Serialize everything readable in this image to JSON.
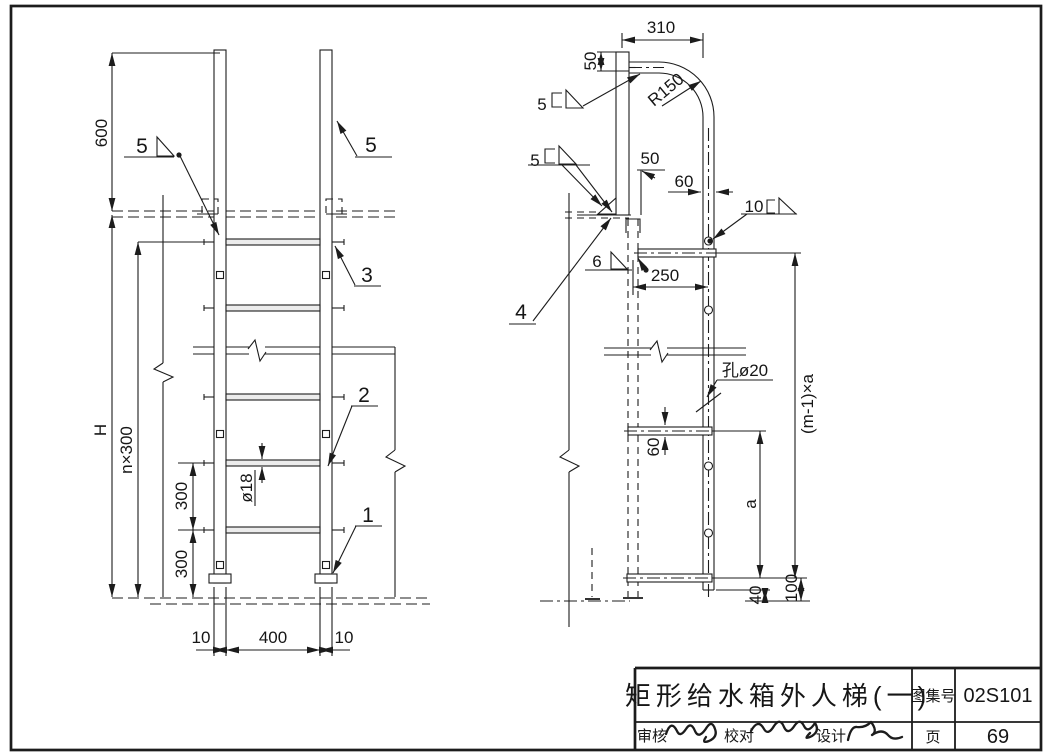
{
  "front_view": {
    "dims": {
      "height_600": "600",
      "tank_h": "H",
      "pitch_total": "n×300",
      "pitch_300a": "300",
      "pitch_300b": "300",
      "rung_dia": "ø18",
      "thk_left": "10",
      "width_400": "400",
      "thk_right": "10"
    },
    "parts": {
      "p1": "1",
      "p2": "2",
      "p3": "3",
      "p5_left": "5",
      "p5_right": "5"
    }
  },
  "side_view": {
    "dims": {
      "run_310": "310",
      "drop_50": "50",
      "radius": "R150",
      "offset_50": "50",
      "rail_60": "60",
      "span_250": "250",
      "hole_callout": "孔ø20",
      "bracket_60": "60",
      "pitch_a": "a",
      "total_ma": "(m-1)×a",
      "bottom_40": "40",
      "bottom_100": "100"
    },
    "welds": {
      "size_5_top": "5",
      "size_5_mid": "5",
      "size_10": "10",
      "size_6": "6"
    },
    "parts": {
      "p4": "4"
    }
  },
  "title_block": {
    "title": "矩形给水箱外人梯(一)",
    "atlas_label": "图集号",
    "atlas_no": "02S101",
    "page_label": "页",
    "page_no": "69",
    "reviewer_label": "审核",
    "checker_label": "校对",
    "designer_label": "设计"
  }
}
